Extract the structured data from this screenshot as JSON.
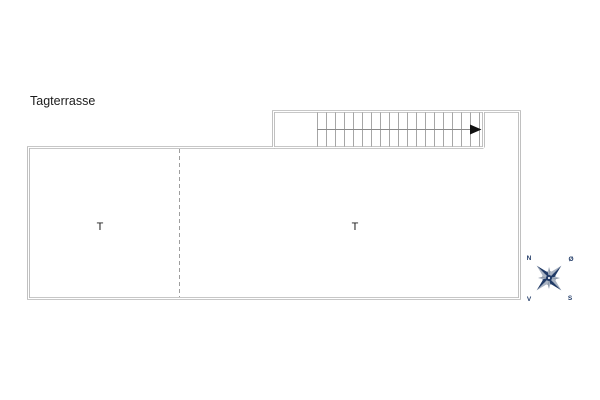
{
  "plan": {
    "title": "Tagterrasse",
    "rooms": [
      {
        "label": "T",
        "position": "left"
      },
      {
        "label": "T",
        "position": "right"
      }
    ],
    "stair": {
      "tread_count": 19,
      "direction": "right"
    },
    "line_color": "#a6a6a6",
    "dash_color": "#9e9e9e",
    "centerline_color": "#8a8a8a",
    "arrow_color": "#111111",
    "text_color": "#1c1c1c"
  },
  "compass": {
    "labels": {
      "north": "N",
      "east": "Ø",
      "south": "S",
      "west": "V"
    },
    "primary_color": "#203a66",
    "secondary_color": "#aab4c3",
    "accent_color": "#8e99a9"
  }
}
